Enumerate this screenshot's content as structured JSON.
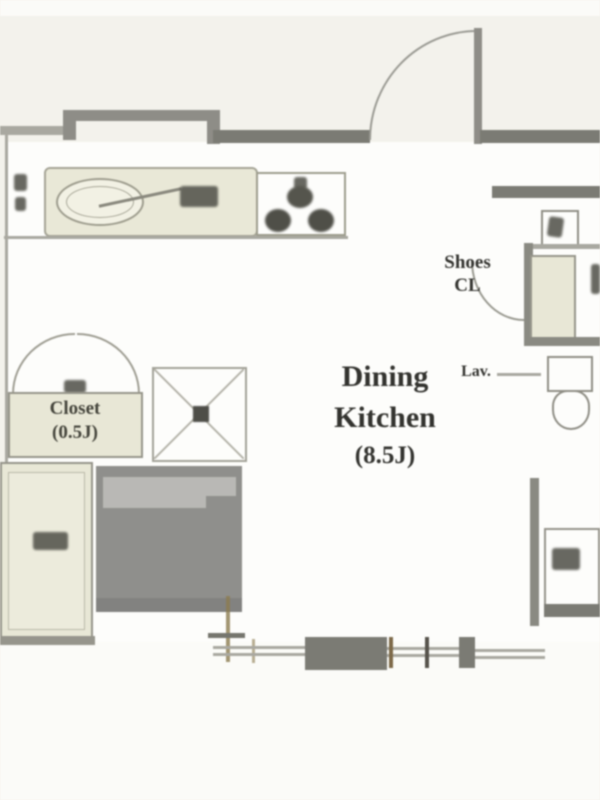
{
  "floorplan": {
    "room_main": {
      "name_line1": "Dining",
      "name_line2": "Kitchen",
      "size": "(8.5J)"
    },
    "shoes_closet": {
      "line1": "Shoes",
      "line2": "CL"
    },
    "closet": {
      "line1": "Closet",
      "size": "(0.5J)"
    },
    "lavatory_label": "Lav.",
    "colors": {
      "background": "#f3f2ec",
      "paper": "#fbfbf8",
      "floor_white": "#fdfdfb",
      "wall_dark": "#7b7b74",
      "wall_mid": "#8e8d87",
      "fixture_beige": "#e8e7d6",
      "gray_block": "#8f8f8c",
      "gray_block_light": "#b9b8b5",
      "window_tick_olive": "#8c7c50",
      "label_ink": "#33332f"
    }
  }
}
